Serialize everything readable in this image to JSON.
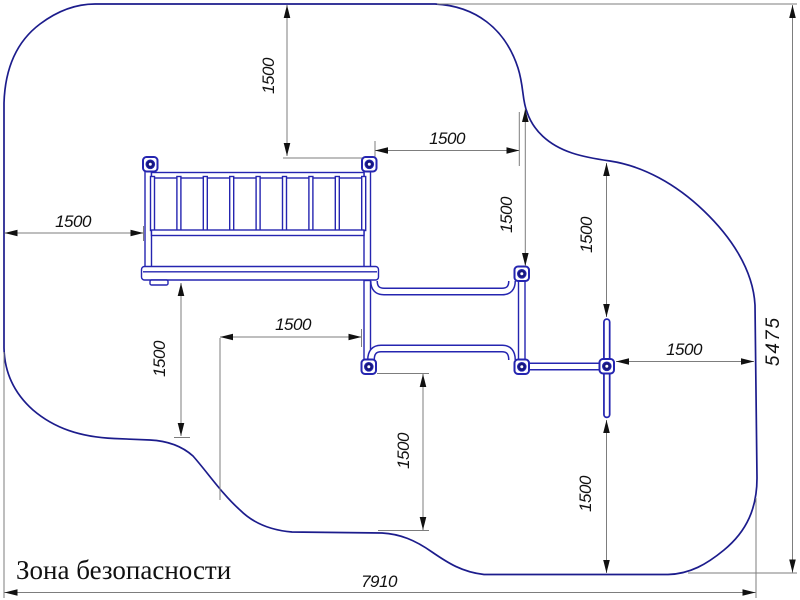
{
  "drawing": {
    "title": "Зона безопасности",
    "type": "playground-equipment-safety-zone-plan"
  },
  "colors": {
    "background": "#ffffff",
    "boundary": "#1c1c8c",
    "equipment": "#2525b0",
    "equipment_dark": "#16167e",
    "dimension_line": "#7d7d7d",
    "ink": "#111111"
  },
  "dimensions": [
    {
      "name": "offset-left",
      "value": "1500",
      "orientation": "horizontal"
    },
    {
      "name": "offset-top",
      "value": "1500",
      "orientation": "vertical"
    },
    {
      "name": "ladder-to-bridge-post",
      "value": "1500",
      "orientation": "horizontal"
    },
    {
      "name": "zone-to-bridge-top-post",
      "value": "1500",
      "orientation": "vertical"
    },
    {
      "name": "zone-to-beam-top",
      "value": "1500",
      "orientation": "vertical"
    },
    {
      "name": "beam-to-zone-right",
      "value": "1500",
      "orientation": "horizontal"
    },
    {
      "name": "platform-to-zone-bottom-left",
      "value": "1500",
      "orientation": "vertical"
    },
    {
      "name": "zone-to-bridge-lower-post",
      "value": "1500",
      "orientation": "horizontal"
    },
    {
      "name": "bridge-post-to-zone-bottom",
      "value": "1500",
      "orientation": "vertical"
    },
    {
      "name": "beam-to-zone-bottom",
      "value": "1500",
      "orientation": "vertical"
    },
    {
      "name": "zone-width",
      "value": "7910",
      "orientation": "horizontal"
    },
    {
      "name": "zone-height",
      "value": "5475",
      "orientation": "vertical"
    }
  ]
}
